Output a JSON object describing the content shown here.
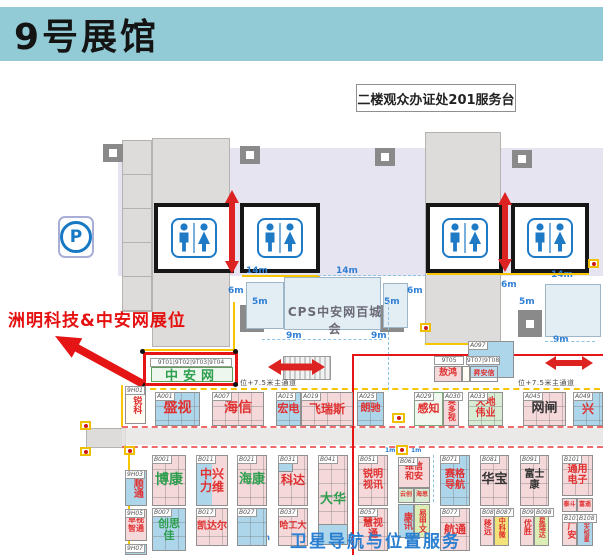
{
  "header": {
    "title": "9号展馆"
  },
  "labels": {
    "service_desk": "二楼观众办证处201服务台",
    "cps": "CPS中安网百城会",
    "aisle_left": "位+7.5米主通道",
    "aisle_right": "位+7.5米主通道",
    "satellite": "卫星导航与位置服务",
    "parking": "P"
  },
  "annotation": {
    "text": "洲明科技&中安网展位"
  },
  "highlight": {
    "ids": "9T01|9T02|9T03|9T04",
    "name": "中安网"
  },
  "dims": [
    "14m",
    "14m",
    "6m",
    "5m",
    "5m",
    "6m",
    "9m",
    "9m",
    "14m",
    "6m",
    "5m",
    "9m",
    "1m",
    "1m",
    "3m"
  ],
  "colors": {
    "header_bg": "#92cbd5",
    "lavender": "#e7e4f1",
    "booth_blue": "#aed6ea",
    "booth_pink": "#f5d8da",
    "booth_green": "#d7ecd2",
    "booth_yellow": "#f3e27a",
    "accent_red": "#e51515",
    "dim_blue": "#2f7fd4",
    "text_red": "#e03030",
    "text_green": "#2e9e4f"
  },
  "booths": {
    "ruike": {
      "id": "9H01",
      "name": "锐科"
    },
    "shengshi": {
      "id": "A001",
      "name": "盛视"
    },
    "haixin": {
      "id": "A007",
      "name": "海信"
    },
    "hongdian": {
      "id": "A015",
      "name": "宏电"
    },
    "feiruisi": {
      "id": "A019",
      "name": "飞瑞斯"
    },
    "langchi": {
      "id": "A025",
      "name": "朗驰"
    },
    "ganzhi": {
      "id": "A029",
      "name": "感知"
    },
    "aoduoshi": {
      "id": "A030",
      "name": "奥多视"
    },
    "tiandiweiye": {
      "id": "A033",
      "name": "天地伟业"
    },
    "wangzha": {
      "id": "A045",
      "name": "网闸"
    },
    "xing": {
      "id": "A049",
      "name": "兴"
    },
    "a097": {
      "id": "A097"
    },
    "aohong": {
      "id": "9T05",
      "name": "敖鸿"
    },
    "shenganxin": {
      "id": "9T07|9T08",
      "name": "昇安信"
    },
    "shuntong": {
      "id": "9H03",
      "name": "顺通"
    },
    "zhuoshizhitong": {
      "id": "9H05",
      "name": "卓视智通"
    },
    "h907": {
      "id": "9H07"
    },
    "bokang": {
      "id": "B001",
      "name": "博康"
    },
    "chuangsijia": {
      "id": "B007",
      "name": "创思佳"
    },
    "zhongxingliwei": {
      "id": "B011",
      "name": "中兴力维"
    },
    "kaidaer": {
      "id": "B017",
      "name": "凯达尔"
    },
    "haikang": {
      "id": "B021",
      "name": "海康"
    },
    "b027": {
      "id": "B027"
    },
    "keda": {
      "id": "B031",
      "name": "科达"
    },
    "hagongda": {
      "id": "B037",
      "name": "哈工大"
    },
    "dahua": {
      "id": "B041",
      "name": "大华"
    },
    "ruimingshixun": {
      "id": "B051",
      "name": "锐明视讯"
    },
    "huishitong": {
      "id": "B057",
      "name": "慧视通"
    },
    "weixinhean": {
      "id": "B061",
      "name": "维信和安"
    },
    "yunchuang": {
      "name": "云创"
    },
    "haisi": {
      "name": "海思"
    },
    "kangxun": {
      "name": "康讯"
    },
    "yijiawen": {
      "name": "易甲文"
    },
    "saigedaohang": {
      "id": "B071",
      "name": "赛格导航"
    },
    "hangtong": {
      "id": "B077",
      "name": "航通"
    },
    "huabao": {
      "id": "B081",
      "name": "华宝"
    },
    "yiyuan": {
      "id": "B086",
      "name": "移远"
    },
    "zhongkewei": {
      "id": "B087",
      "name": "中科微"
    },
    "fushikang": {
      "id": "B091",
      "name": "富士康"
    },
    "yousheng": {
      "id": "B097",
      "name": "优胜"
    },
    "xingruida": {
      "id": "B098",
      "name": "星瑞达"
    },
    "tongyongdianzi": {
      "id": "B101",
      "name": "通用电子"
    },
    "taidou": {
      "id": "B105",
      "name": "泰斗"
    },
    "fuyao": {
      "id": "B106",
      "name": "富遥"
    },
    "guangan": {
      "id": "B107",
      "name": "广安"
    },
    "hangtianhengxing": {
      "id": "B108",
      "name": "航天恒星"
    }
  }
}
